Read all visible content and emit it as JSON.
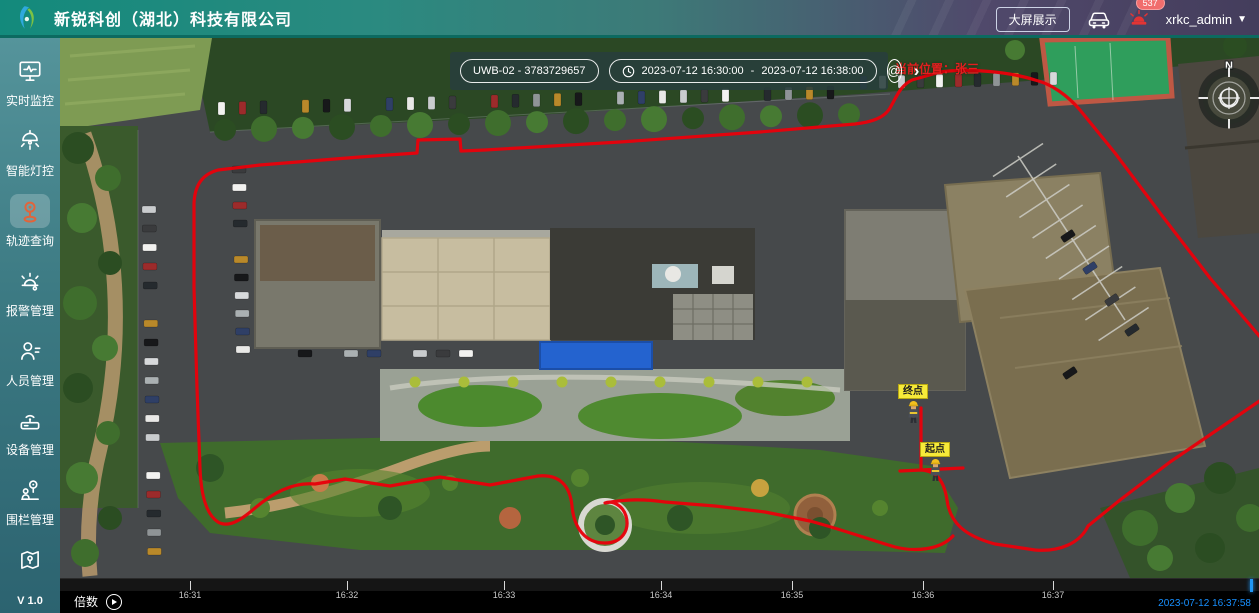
{
  "header": {
    "title": "新锐科创（湖北）科技有限公司",
    "big_screen_button": "大屏展示",
    "alarm_count": "537",
    "username": "xrkc_admin"
  },
  "sidebar": {
    "items": [
      {
        "label": "实时监控"
      },
      {
        "label": "智能灯控"
      },
      {
        "label": "轨迹查询"
      },
      {
        "label": "报警管理"
      },
      {
        "label": "人员管理"
      },
      {
        "label": "设备管理"
      },
      {
        "label": "围栏管理"
      },
      {
        "label": ""
      }
    ],
    "version": "V 1.0"
  },
  "toolbar": {
    "device": "UWB-02 - 3783729657",
    "start_time": "2023-07-12 16:30:00",
    "separator": "-",
    "end_time": "2023-07-12 16:38:00"
  },
  "map": {
    "current_position": "当前位置：张三",
    "end_marker": "终点",
    "start_marker": "起点",
    "compass_n": "N"
  },
  "timeline": {
    "speed_label": "倍数",
    "ticks": [
      "16:31",
      "16:32",
      "16:33",
      "16:34",
      "16:35",
      "16:36",
      "16:37"
    ],
    "current_time": "2023-07-12 16:37:58"
  },
  "colors": {
    "accent_blue": "#1890ff",
    "track_red": "#e8000a",
    "marker_yellow": "#f6ea39"
  }
}
